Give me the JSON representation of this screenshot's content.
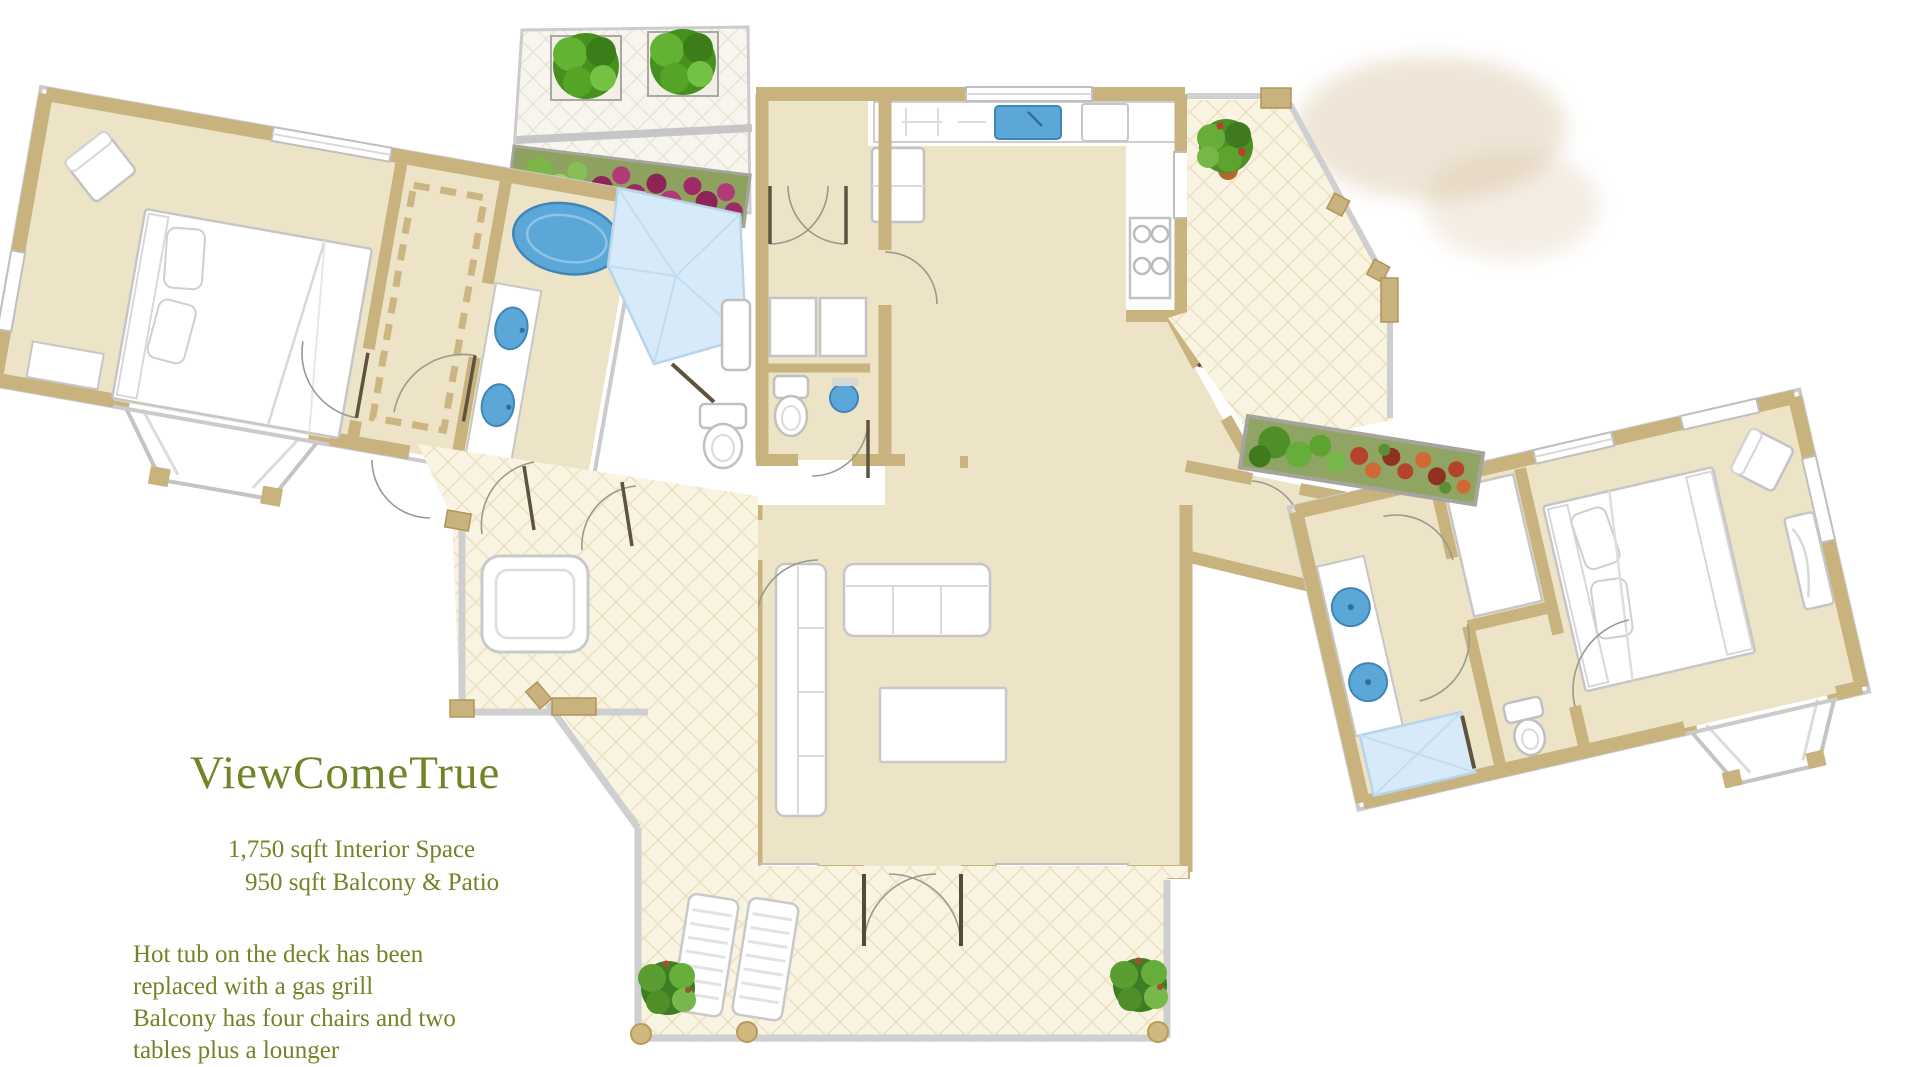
{
  "document": {
    "title": "ViewComeTrue",
    "stats": {
      "interior": "1,750 sqft Interior Space",
      "balcony": "950 sqft Balcony & Patio"
    },
    "notes": {
      "line1": "Hot tub on the deck has been",
      "line2": "replaced with a gas grill",
      "line3": "Balcony has four chairs and two",
      "line4": "tables plus a lounger"
    }
  },
  "palette": {
    "wall_tan": "#c8b27e",
    "floor_cream": "#ede3c6",
    "tile_cream": "#f9f3e1",
    "deck_tile_white": "#f7f5ee",
    "fixture_blue": "#5ba7d7",
    "fixture_blue_dark": "#3e87b8",
    "shower_blue": "#d7eafa",
    "railing_gray": "#cfcfcf",
    "text_green": "#6f8526",
    "plant_green": "#4e8f28",
    "flower_magenta": "#9e2b63",
    "flower_red": "#b5432c",
    "watercolor_smudge": "#cdb085"
  },
  "fixtures": [
    "bed",
    "pillow",
    "corner-chair",
    "walk-in-closet",
    "bathtub",
    "vanity-sink",
    "toilet",
    "shower",
    "kitchen-sink",
    "dishwasher",
    "refrigerator",
    "stove",
    "sofa",
    "sectional-sofa",
    "coffee-table",
    "cypress-plant",
    "potted-plant",
    "planter-box",
    "shrub-planter",
    "flower-box",
    "gas-grill",
    "lounge-chair",
    "fern",
    "bay-window",
    "french-doors",
    "railing"
  ]
}
